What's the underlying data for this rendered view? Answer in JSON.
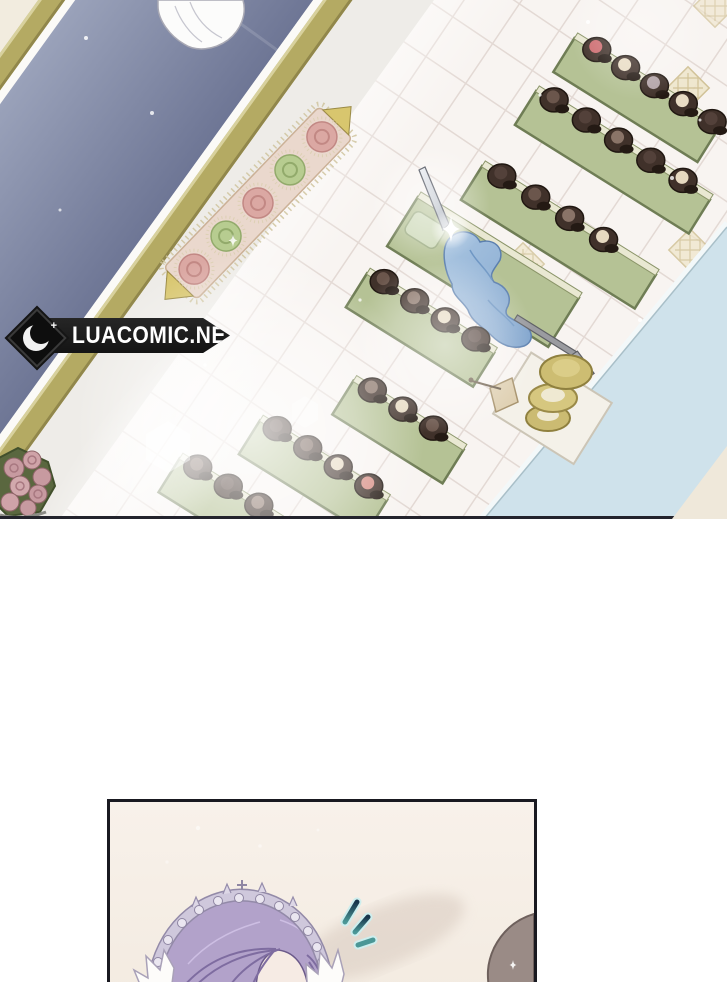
{
  "watermark": {
    "site": "LUACOMIC.NET",
    "icon": "crescent-moon-icon",
    "plus_glyph": "+"
  },
  "panels": [
    {
      "name": "shop-overview-panel"
    },
    {
      "name": "character-closeup-panel"
    }
  ],
  "palette": {
    "carpet_blue": "#8d94af",
    "gold_trim": "#b4aa63",
    "walkway": "#eeece8",
    "tile": "#f8f4f1",
    "tile_grout": "#e3d9d4",
    "table_green": "#b5c295",
    "table_edge": "#6f7d55",
    "hat_dark": "#40312a",
    "hat_cream": "#e9dcc4",
    "hat_red": "#cd6b6f",
    "dress_blue": "#8fb1d6",
    "counter_blue": "#cfe2eb",
    "gold_hat": "#cdbd72",
    "rose_pink": "#dba8a3",
    "rose_green": "#b7cc90",
    "hair_purple": "#b2a2ca",
    "tiara_silver": "#cfc8dc",
    "panel_cream": "#f7f0e8",
    "mark_teal": "#4b9796",
    "mark_navy": "#17344a",
    "banner_black": "#191919",
    "border_dark": "#23232c",
    "watermark_text_color": "#ffffff"
  }
}
